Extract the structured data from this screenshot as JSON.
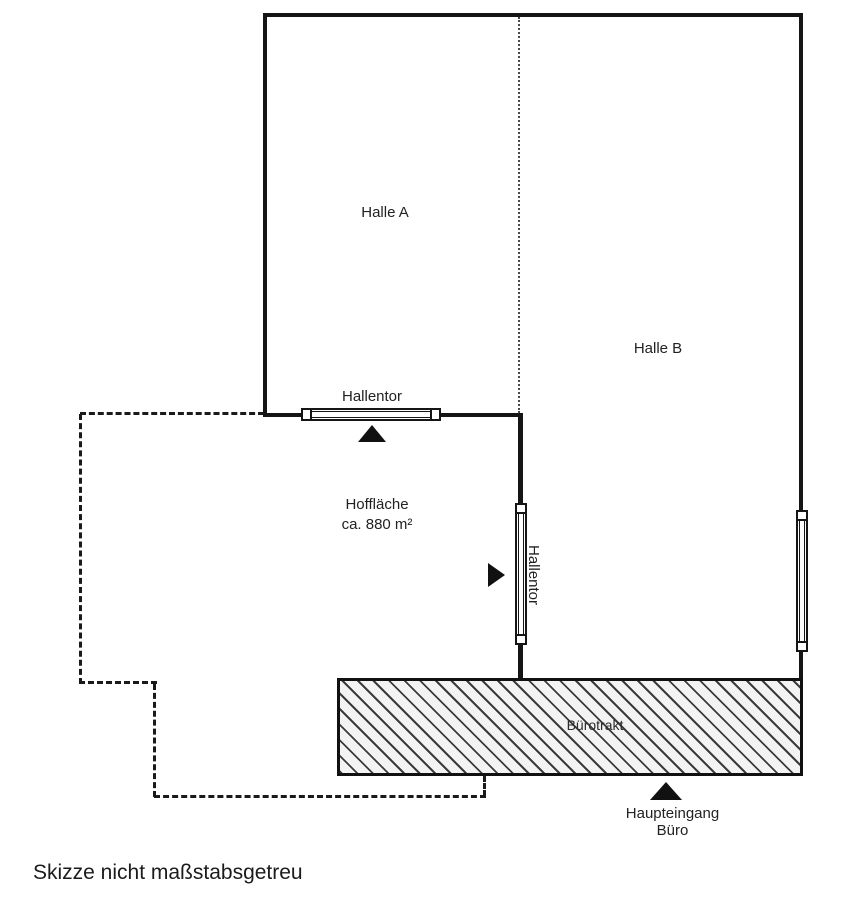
{
  "diagram": {
    "type": "floor_plan_sketch",
    "footnote": "Skizze nicht maßstabsgetreu",
    "rooms": {
      "halle_a": {
        "label": "Halle A"
      },
      "halle_b": {
        "label": "Halle B"
      },
      "courtyard": {
        "label": "Hoffläche",
        "area": "ca. 880 m²"
      },
      "office_wing": {
        "label": "Bürotrakt"
      }
    },
    "gates": {
      "top": {
        "label": "Hallentor"
      },
      "side": {
        "label": "Hallentor"
      }
    },
    "entrance": {
      "line1": "Haupteingang",
      "line2": "Büro"
    },
    "icons": {
      "gate_top_arrow": "triangle-up",
      "gate_side_arrow": "triangle-right",
      "entrance_arrow": "triangle-up"
    },
    "colors": {
      "background": "#ffffff",
      "wall": "#151515",
      "text": "#222222",
      "hatch_line": "#3c3c3c",
      "hatch_background": "#f3f3f3"
    }
  }
}
